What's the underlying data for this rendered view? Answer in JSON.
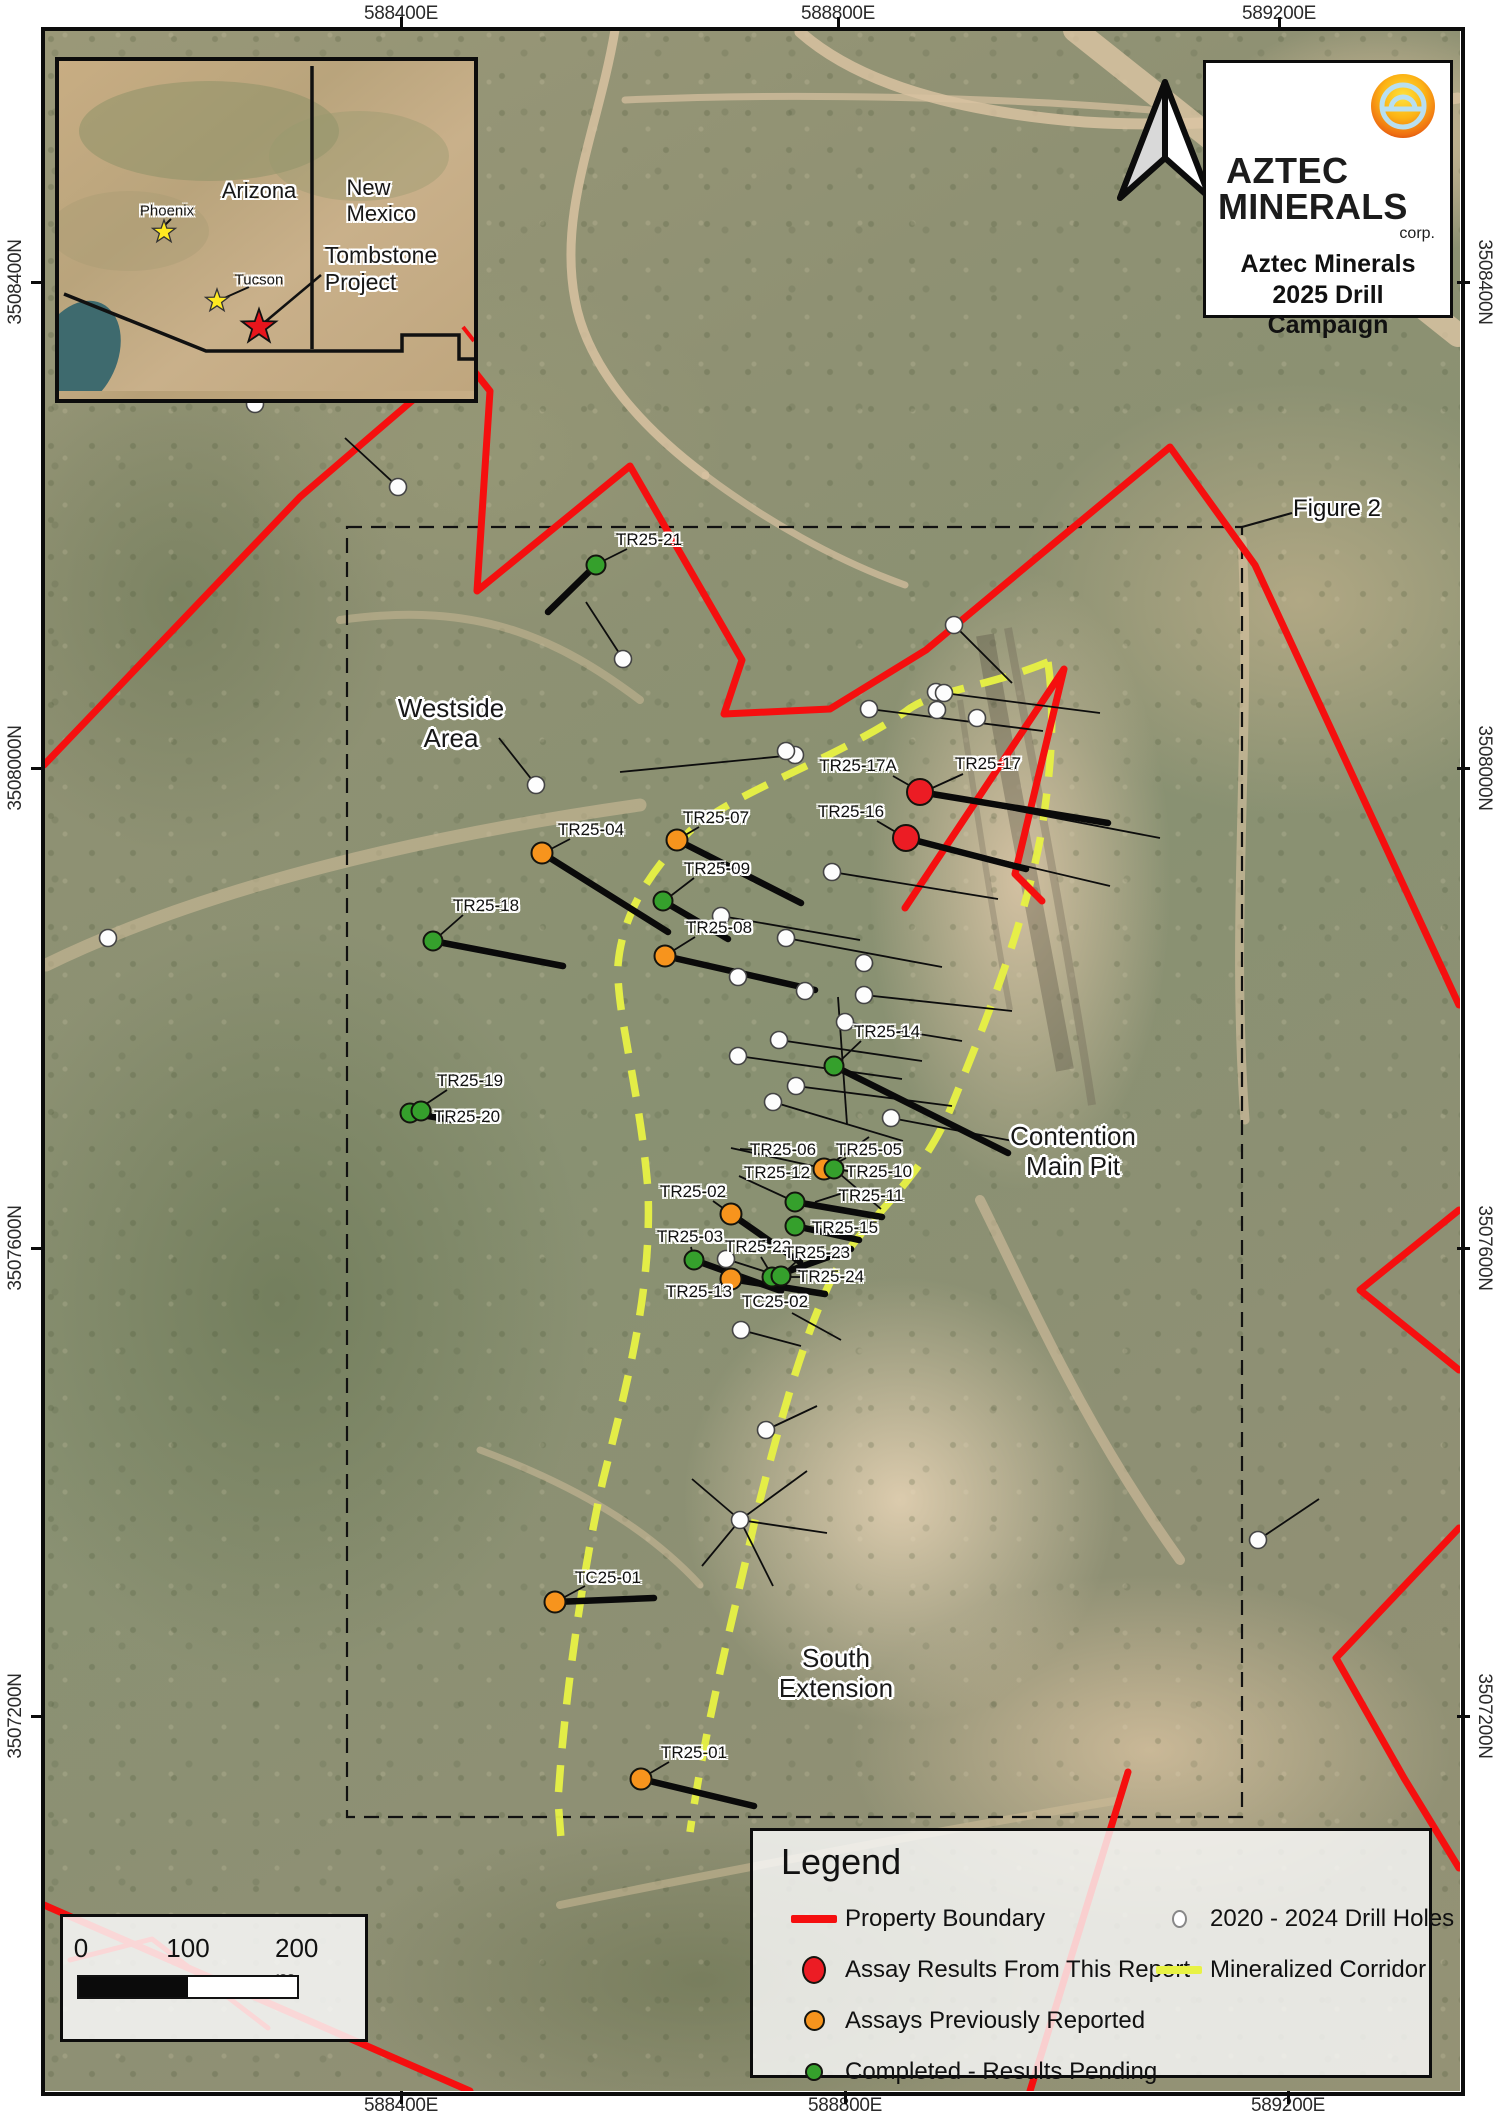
{
  "title_block": {
    "company_line1": "AZTEC",
    "company_line2": "MINERALS",
    "company_suffix": "corp.",
    "title": "Aztec Minerals\n2025 Drill\nCampaign",
    "logo_icon": "sun-bridge-logo"
  },
  "figure_label": "Figure 2",
  "inset": {
    "labels": {
      "arizona": {
        "text": "Arizona",
        "x": 200,
        "y": 130,
        "size": 22
      },
      "new_mexico": {
        "text": "New Mexico",
        "x": 330,
        "y": 140,
        "size": 22
      },
      "phoenix": {
        "text": "Phoenix",
        "x": 108,
        "y": 150,
        "size": 15
      },
      "tucson": {
        "text": "Tucson",
        "x": 200,
        "y": 219,
        "size": 15
      },
      "tombstone": {
        "text": "Tombstone\nProject",
        "x": 322,
        "y": 208,
        "size": 23
      }
    }
  },
  "area_labels": [
    {
      "id": "westside-area",
      "text": "Westside\nArea",
      "x": 451,
      "y": 724
    },
    {
      "id": "contention-main-pit",
      "text": "Contention\nMain Pit",
      "x": 1073,
      "y": 1152
    },
    {
      "id": "south-extension",
      "text": "South\nExtension",
      "x": 836,
      "y": 1674
    }
  ],
  "axis": {
    "top": [
      {
        "label": "588400E",
        "x": 401
      },
      {
        "label": "588800E",
        "x": 838
      },
      {
        "label": "589200E",
        "x": 1279
      }
    ],
    "bottom": [
      {
        "label": "588400E",
        "x": 401
      },
      {
        "label": "588800E",
        "x": 845
      },
      {
        "label": "589200E",
        "x": 1288
      }
    ],
    "left": [
      {
        "label": "3508400N",
        "y": 282
      },
      {
        "label": "3508000N",
        "y": 768
      },
      {
        "label": "3507600N",
        "y": 1248
      },
      {
        "label": "3507200N",
        "y": 1716
      }
    ],
    "right": [
      {
        "label": "3508400N",
        "y": 282
      },
      {
        "label": "3508000N",
        "y": 768
      },
      {
        "label": "3507600N",
        "y": 1248
      },
      {
        "label": "3507200N",
        "y": 1716
      }
    ]
  },
  "legend": {
    "title": "Legend",
    "items": [
      {
        "label": "Property Boundary",
        "swatch": "line-red",
        "col": 1
      },
      {
        "label": "Assay Results From This Report",
        "swatch": "dot-red",
        "col": 1
      },
      {
        "label": "Assays Previously Reported",
        "swatch": "dot-orange",
        "col": 1
      },
      {
        "label": "Completed - Results Pending",
        "swatch": "dot-green",
        "col": 1
      },
      {
        "label": "2020 - 2024 Drill Holes",
        "swatch": "dot-white",
        "col": 2
      },
      {
        "label": "Mineralized Corridor",
        "swatch": "line-yellow",
        "col": 2
      }
    ]
  },
  "scalebar": {
    "labels": [
      {
        "text": "0",
        "x": 18
      },
      {
        "text": "100",
        "x": 125
      },
      {
        "text": "200 m",
        "x": 242
      }
    ]
  },
  "colors": {
    "boundary": "#f50f0f",
    "corridor": "#e8f244",
    "red": "#ec1c24",
    "orange": "#f7941d",
    "green": "#35a02c",
    "white": "#fdfdfd",
    "trace": "#0a0a0a"
  },
  "drill_holes": [
    {
      "id": "TR25-21",
      "label": [
        649,
        540
      ],
      "dot": [
        596,
        565
      ],
      "status": "green",
      "trace": [
        596,
        565,
        548,
        612
      ],
      "leader": [
        627,
        549,
        601,
        562
      ]
    },
    {
      "id": "TR25-17A",
      "label": [
        858,
        766
      ],
      "dot": [
        920,
        792
      ],
      "status": "red",
      "trace": [
        920,
        792,
        1108,
        823
      ],
      "leader": [
        893,
        776,
        914,
        788
      ]
    },
    {
      "id": "TR25-17",
      "label": [
        988,
        764
      ],
      "dot": null,
      "status": "red",
      "trace": null,
      "leader": [
        963,
        774,
        930,
        789
      ]
    },
    {
      "id": "TR25-16",
      "label": [
        851,
        812
      ],
      "dot": [
        906,
        838
      ],
      "status": "red",
      "trace": [
        906,
        838,
        1026,
        869
      ],
      "leader": [
        877,
        821,
        899,
        834
      ]
    },
    {
      "id": "TR25-04",
      "label": [
        591,
        830
      ],
      "dot": [
        542,
        853
      ],
      "status": "orange",
      "trace": [
        542,
        853,
        668,
        932
      ],
      "leader": [
        570,
        839,
        549,
        850
      ]
    },
    {
      "id": "TR25-07",
      "label": [
        716,
        818
      ],
      "dot": [
        677,
        840
      ],
      "status": "orange",
      "trace": [
        677,
        840,
        801,
        903
      ],
      "leader": [
        699,
        827,
        682,
        837
      ]
    },
    {
      "id": "TR25-09",
      "label": [
        717,
        869
      ],
      "dot": [
        663,
        901
      ],
      "status": "green",
      "trace": [
        663,
        901,
        728,
        939
      ],
      "leader": [
        694,
        878,
        668,
        898
      ]
    },
    {
      "id": "TR25-18",
      "label": [
        486,
        906
      ],
      "dot": [
        433,
        941
      ],
      "status": "green",
      "trace": [
        433,
        941,
        563,
        966
      ],
      "leader": [
        463,
        915,
        438,
        937
      ]
    },
    {
      "id": "TR25-08",
      "label": [
        719,
        928
      ],
      "dot": [
        665,
        956
      ],
      "status": "orange",
      "trace": [
        665,
        956,
        815,
        990
      ],
      "leader": [
        695,
        937,
        671,
        952
      ]
    },
    {
      "id": "TR25-14",
      "label": [
        887,
        1032
      ],
      "dot": [
        834,
        1066
      ],
      "status": "green",
      "trace": [
        834,
        1066,
        1008,
        1153
      ],
      "leader": [
        861,
        1041,
        840,
        1061
      ]
    },
    {
      "id": "TR25-19",
      "label": [
        470,
        1081
      ],
      "dot": [
        410,
        1113
      ],
      "status": "green",
      "trace": [
        410,
        1113,
        452,
        1120
      ],
      "leader": [
        447,
        1090,
        417,
        1110
      ]
    },
    {
      "id": "TR25-20",
      "label": [
        467,
        1117
      ],
      "dot": [
        421,
        1111
      ],
      "status": "green",
      "trace": null,
      "leader": null
    },
    {
      "id": "TR25-06",
      "label": [
        783,
        1150
      ],
      "dot": [
        731,
        1148
      ],
      "status": "white",
      "trace": null,
      "leader": [
        757,
        1150,
        740,
        1149
      ]
    },
    {
      "id": "TR25-05",
      "label": [
        869,
        1150
      ],
      "dot": [
        824,
        1169
      ],
      "status": "orange",
      "trace": null,
      "leader": [
        846,
        1158,
        831,
        1166
      ]
    },
    {
      "id": "TR25-12",
      "label": [
        777,
        1173
      ],
      "dot": [
        739,
        1176
      ],
      "status": "white",
      "trace": null,
      "leader": null
    },
    {
      "id": "TR25-10",
      "label": [
        879,
        1172
      ],
      "dot": [
        834,
        1169
      ],
      "status": "green",
      "trace": null,
      "leader": [
        854,
        1172,
        841,
        1170
      ]
    },
    {
      "id": "TR25-11",
      "label": [
        871,
        1196
      ],
      "dot": null,
      "status": "green",
      "trace": null,
      "leader": [
        843,
        1193,
        815,
        1202
      ]
    },
    {
      "id": "TR25-02",
      "label": [
        693,
        1192
      ],
      "dot": [
        731,
        1214
      ],
      "status": "orange",
      "trace": [
        731,
        1214,
        800,
        1262
      ],
      "leader": [
        713,
        1201,
        727,
        1211
      ]
    },
    {
      "id": "TR25-15",
      "label": [
        845,
        1228
      ],
      "dot": [
        795,
        1226
      ],
      "status": "green",
      "trace": [
        795,
        1226,
        859,
        1240
      ],
      "leader": [
        819,
        1228,
        802,
        1227
      ]
    },
    {
      "id": "TR25-03",
      "label": [
        690,
        1237
      ],
      "dot": [
        694,
        1260
      ],
      "status": "green",
      "trace": [
        694,
        1260,
        781,
        1291
      ],
      "leader": [
        691,
        1247,
        693,
        1256
      ]
    },
    {
      "id": "TR25-22",
      "label": [
        758,
        1247
      ],
      "dot": [
        772,
        1277
      ],
      "status": "green",
      "trace": [
        772,
        1277,
        851,
        1249
      ],
      "leader": [
        761,
        1257,
        770,
        1272
      ]
    },
    {
      "id": "TR25-23",
      "label": [
        817,
        1253
      ],
      "dot": [
        781,
        1276
      ],
      "status": "green",
      "trace": null,
      "leader": [
        797,
        1261,
        785,
        1272
      ]
    },
    {
      "id": "TR25-24",
      "label": [
        831,
        1277
      ],
      "dot": null,
      "status": "green",
      "trace": null,
      "leader": [
        804,
        1277,
        788,
        1277
      ]
    },
    {
      "id": "TR25-13",
      "label": [
        699,
        1292
      ],
      "dot": [
        731,
        1279
      ],
      "status": "orange",
      "trace": [
        731,
        1279,
        825,
        1294
      ],
      "leader": [
        713,
        1287,
        726,
        1281
      ]
    },
    {
      "id": "TC25-02",
      "label": [
        775,
        1302
      ],
      "dot": null,
      "status": "none",
      "trace": null,
      "leader": [
        792,
        1313,
        841,
        1340
      ]
    },
    {
      "id": "TC25-01",
      "label": [
        608,
        1578
      ],
      "dot": [
        555,
        1602
      ],
      "status": "orange",
      "trace": [
        555,
        1602,
        654,
        1598
      ],
      "leader": [
        585,
        1586,
        561,
        1599
      ]
    },
    {
      "id": "TR25-01",
      "label": [
        694,
        1753
      ],
      "dot": [
        641,
        1779
      ],
      "status": "orange",
      "trace": [
        641,
        1779,
        754,
        1806
      ],
      "leader": [
        669,
        1762,
        647,
        1775
      ]
    }
  ],
  "extra_dots": [
    {
      "dot": [
        795,
        1202
      ],
      "status": "green",
      "trace": [
        795,
        1202,
        882,
        1217
      ]
    }
  ],
  "white_holes": [
    [
      398,
      487
    ],
    [
      255,
      404
    ],
    [
      623,
      659
    ],
    [
      536,
      785
    ],
    [
      108,
      938
    ],
    [
      795,
      755
    ],
    [
      954,
      625
    ],
    [
      936,
      692
    ],
    [
      944,
      693
    ],
    [
      937,
      710
    ],
    [
      977,
      718
    ],
    [
      869,
      709
    ],
    [
      786,
      751
    ],
    [
      832,
      872
    ],
    [
      786,
      938
    ],
    [
      721,
      916
    ],
    [
      864,
      963
    ],
    [
      864,
      995
    ],
    [
      845,
      1022
    ],
    [
      738,
      977
    ],
    [
      805,
      991
    ],
    [
      779,
      1040
    ],
    [
      738,
      1056
    ],
    [
      796,
      1086
    ],
    [
      773,
      1102
    ],
    [
      891,
      1118
    ],
    [
      726,
      1259
    ],
    [
      741,
      1330
    ],
    [
      766,
      1430
    ],
    [
      740,
      1520
    ],
    [
      1258,
      1540
    ]
  ],
  "thin_lines": [
    [
      398,
      487,
      345,
      438
    ],
    [
      255,
      404,
      208,
      373
    ],
    [
      623,
      659,
      586,
      602
    ],
    [
      536,
      785,
      499,
      738
    ],
    [
      795,
      755,
      620,
      772
    ],
    [
      869,
      709,
      1043,
      731
    ],
    [
      954,
      625,
      1012,
      683
    ],
    [
      936,
      692,
      1100,
      713
    ],
    [
      832,
      872,
      998,
      899
    ],
    [
      786,
      938,
      942,
      967
    ],
    [
      864,
      995,
      1012,
      1011
    ],
    [
      845,
      1022,
      962,
      1041
    ],
    [
      779,
      1040,
      922,
      1061
    ],
    [
      738,
      1056,
      902,
      1079
    ],
    [
      796,
      1086,
      952,
      1106
    ],
    [
      773,
      1102,
      903,
      1141
    ],
    [
      891,
      1118,
      1013,
      1141
    ],
    [
      731,
      1148,
      813,
      1166
    ],
    [
      739,
      1176,
      791,
      1200
    ],
    [
      726,
      1259,
      779,
      1276
    ],
    [
      741,
      1330,
      801,
      1346
    ],
    [
      766,
      1430,
      817,
      1406
    ],
    [
      740,
      1520,
      692,
      1479
    ],
    [
      740,
      1520,
      807,
      1471
    ],
    [
      740,
      1520,
      827,
      1533
    ],
    [
      740,
      1520,
      702,
      1566
    ],
    [
      740,
      1520,
      773,
      1586
    ],
    [
      1258,
      1540,
      1319,
      1499
    ],
    [
      838,
      997,
      847,
      1124
    ],
    [
      824,
      1169,
      869,
      1137
    ],
    [
      834,
      1169,
      881,
      1209
    ],
    [
      906,
      838,
      1110,
      886
    ],
    [
      920,
      792,
      1160,
      838
    ],
    [
      721,
      916,
      860,
      940
    ]
  ]
}
